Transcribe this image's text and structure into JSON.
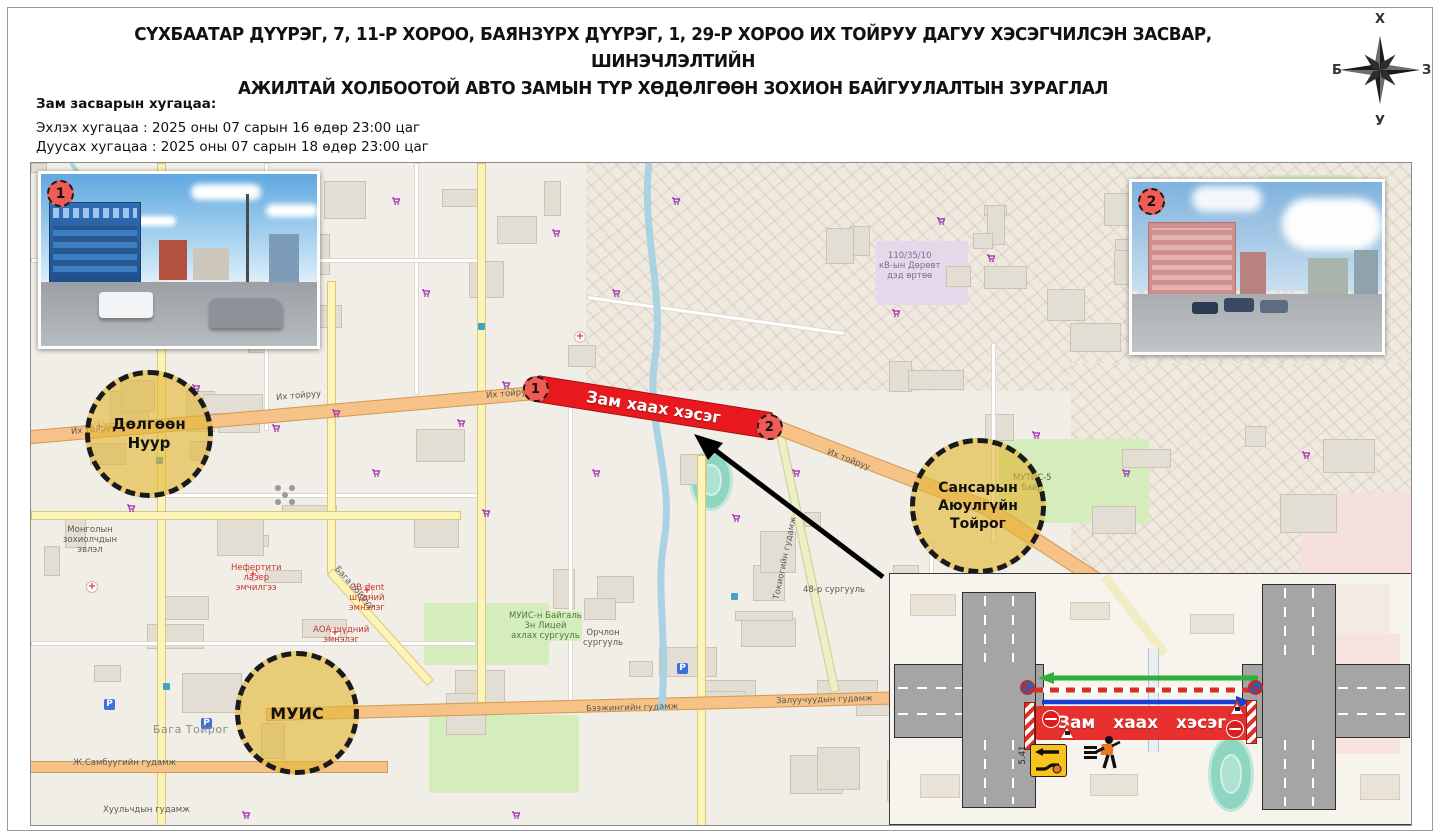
{
  "title": {
    "line1": "СҮХБААТАР ДҮҮРЭГ, 7, 11-Р ХОРОО, БАЯНЗҮРХ ДҮҮРЭГ, 1, 29-Р ХОРОО ИХ ТОЙРУУ ДАГУУ ХЭСЭГЧИЛСЭН ЗАСВАР, ШИНЭЧЛЭЛТИЙН",
    "line2": "АЖИЛТАЙ ХОЛБООТОЙ АВТО ЗАМЫН ТҮР ХӨДӨЛГӨӨН ЗОХИОН БАЙГУУЛАЛТЫН ЗУРАГЛАЛ"
  },
  "schedule": {
    "heading": "Зам засварын хугацаа:",
    "start_line": "Эхлэх хугацаа : 2025 оны 07 сарын 16 өдөр 23:00 цаг",
    "end_line": "Дуусах хугацаа : 2025 оны 07 сарын 18 өдөр 23:00 цаг"
  },
  "compass": {
    "north": "Х",
    "south": "У",
    "east": "З",
    "west": "Б"
  },
  "photos": {
    "photo1_marker": "1",
    "photo2_marker": "2"
  },
  "map": {
    "zones": {
      "dolgoon": "Дөлгөөн\nНуур",
      "sansar": "Сансарын\nАюулгүйн\nТойрог",
      "muis": "МУИС"
    },
    "closure": {
      "label": "Зам хаах хэсэг",
      "marker_start": "1",
      "marker_end": "2"
    },
    "labels": [
      "Их тойруу",
      "Их тойруу",
      "Их тойруу",
      "Бага тойруу",
      "Токиогийн гудамж",
      "Бээжингийн гудамж",
      "Залуучуудын гудамж",
      "Ж.Самбуугийн гудамж",
      "Хуульчдын гудамж",
      "Бага Тойрог",
      "Монголын\nзохиолчдын\nэвлэл",
      "Нефертити\nлазер\nэмчилгээ",
      "GB dent\nшүдний\nэмнэлэг",
      "АОА шүдний\nэмнэлэг",
      "МУИС-н Байгаль\n3н Лицей\nахлах сургууль",
      "100 нас",
      "110/35/10\nкВ-ын Дөрөвт\nдэд өртөө",
      "48-р сургууль",
      "МУТИС-5\nбайр",
      "Орчлон\nсургууль",
      "Их тойруу"
    ]
  },
  "inset": {
    "closure_label": "Зам хаах хэсэг",
    "detour_sign_code": "5.41"
  },
  "colors": {
    "closure_red": "#e8191e",
    "zone_yellow": "#e2b634",
    "road_orange": "#f6c287",
    "road_yellow": "#fcf3b8",
    "water_blue": "#a9d2e2",
    "asphalt_gray": "#a5a5a5",
    "marker_red": "#f15b55"
  }
}
